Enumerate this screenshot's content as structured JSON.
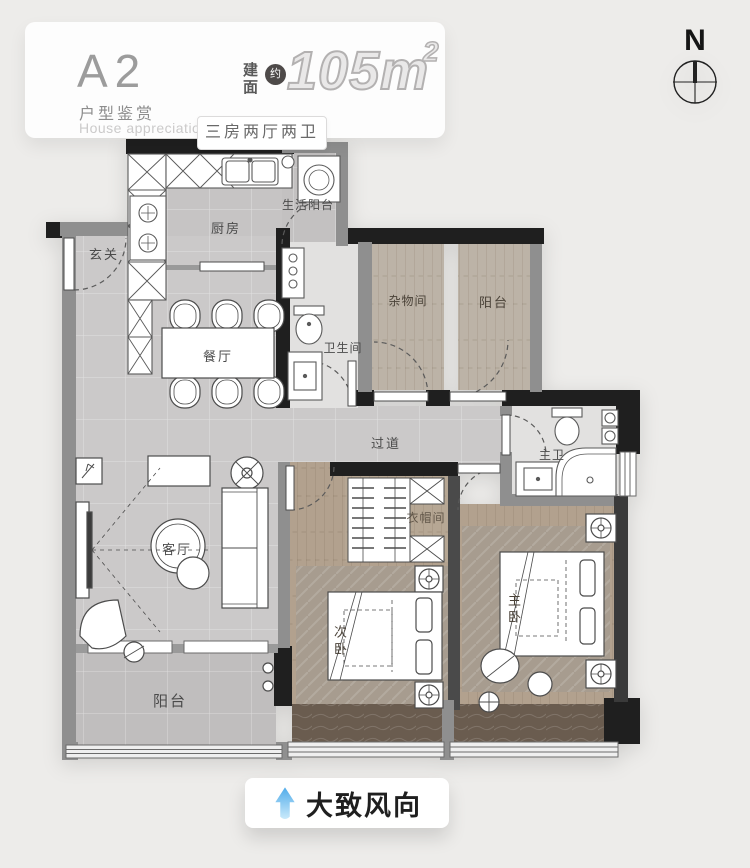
{
  "header": {
    "unit_code": "A2",
    "unit_subtitle": "户型鉴赏",
    "unit_subtitle_en": "House appreciation",
    "area_label_line1": "建",
    "area_label_line2": "面",
    "area_approx_badge": "约",
    "area_value": "105m",
    "area_exponent": "2",
    "layout_spec": "三房两厅两卫"
  },
  "compass": {
    "north": "N"
  },
  "rooms": {
    "entry": "玄关",
    "kitchen": "厨房",
    "service_balcony": "生活阳台",
    "dining": "餐厅",
    "bathroom": "卫生间",
    "storage": "杂物间",
    "balcony_ne": "阳台",
    "corridor": "过道",
    "master_bath": "主卫",
    "closet": "衣帽间",
    "living": "客厅",
    "balcony_sw": "阳台",
    "bedroom_second": "次卧",
    "bedroom_master": "主卧"
  },
  "footer": {
    "wind_direction_label": "大致风向"
  },
  "colors": {
    "structural_wall": "#1f1f1f",
    "light_wall": "#8f8f8f",
    "marble_floor": "#cac8c8",
    "wood_floor": "#b3a28f",
    "bath_floor": "#e2e1e0",
    "window_sill_marble": "#6a5c4f",
    "wind_arrow_blue": "#58b2ec"
  }
}
